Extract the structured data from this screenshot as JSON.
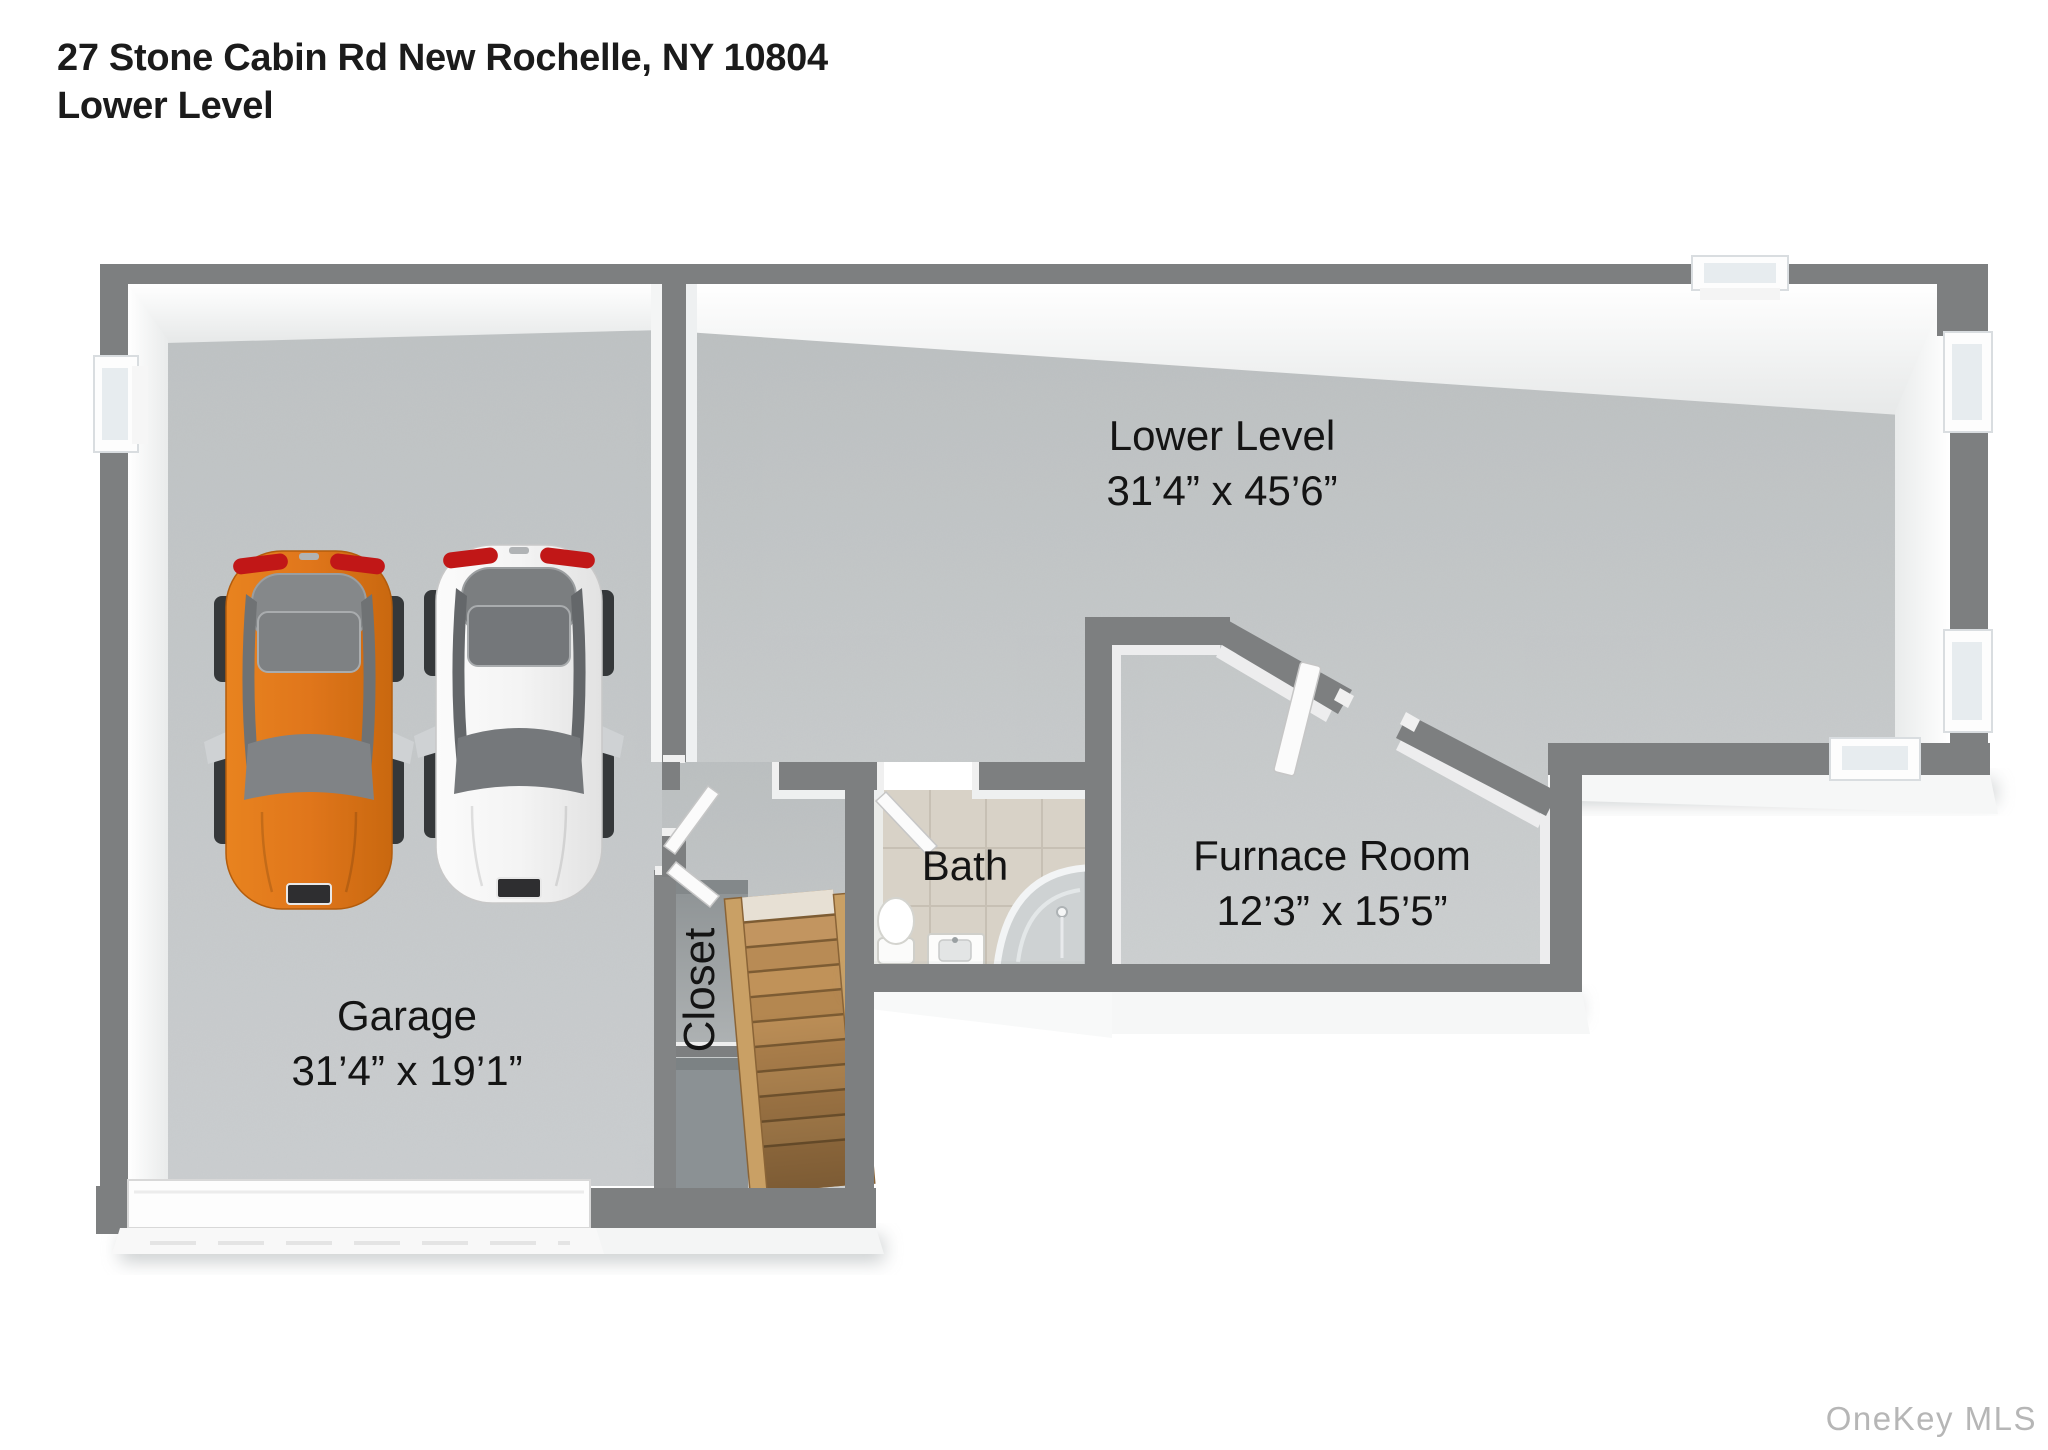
{
  "header": {
    "address": "27 Stone Cabin Rd New Rochelle, NY 10804",
    "level": "Lower Level"
  },
  "watermark": "OneKey MLS",
  "rooms": {
    "lower_level": {
      "name": "Lower Level",
      "dims": "31’4” x 45’6”"
    },
    "garage": {
      "name": "Garage",
      "dims": "31’4” x 19’1”"
    },
    "furnace_room": {
      "name": "Furnace Room",
      "dims": "12’3” x 15’5”"
    },
    "bath": {
      "name": "Bath"
    },
    "closet": {
      "name": "Closet"
    }
  },
  "colors": {
    "wall_gray": "#7d7f80",
    "floor_gray": "#c6c9ca",
    "bath_floor": "#d8d2c7",
    "closet_floor": "#9aa0a2",
    "stair_wood": "#b58852",
    "car_orange": "#e0761b",
    "car_white": "#f6f6f6",
    "glass_gray": "#85888a",
    "watermark_gray": "#b6b6b6"
  }
}
